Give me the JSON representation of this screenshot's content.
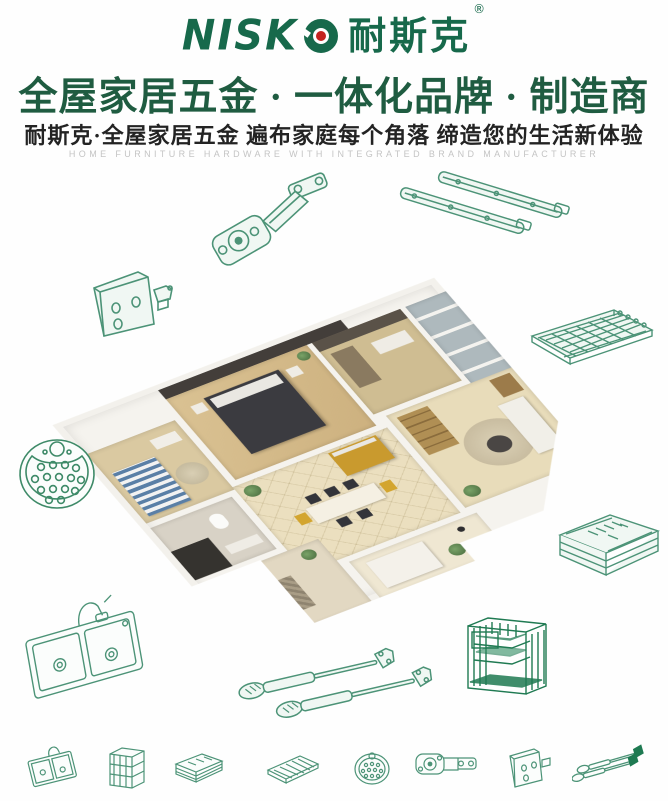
{
  "brand": {
    "latin": "NISK",
    "cjk": "耐斯克",
    "registered": "®"
  },
  "header": {
    "headline": "全屋家居五金 · 一体化品牌 · 制造商",
    "subtitle": "耐斯克·全屋家居五金  遍布家庭每个角落  缔造您的生活新体验",
    "tagline_en": "HOME FURNITURE HARDWARE WITH INTEGRATED BRAND MANUFACTURER"
  },
  "colors": {
    "brand_green": "#17694b",
    "headline_green": "#1f5c41",
    "accent_red": "#c3231f",
    "line_art_green": "#4c9377",
    "product_green": "#1f7a52",
    "subtitle_dark": "#232323",
    "tagline_gray": "#c4c4c4"
  },
  "illustrations": [
    "concealed-hinge",
    "drawer-slides",
    "wall-bracket",
    "wire-shelf",
    "perforated-plate",
    "drawer-basket",
    "kitchen-sink",
    "gas-struts",
    "wire-rack-organizer"
  ],
  "bottom_icons": [
    "sink",
    "wire-cabinet",
    "drawer-basket",
    "wire-shelf",
    "perforated-plate",
    "concealed-hinge",
    "wall-bracket",
    "gas-struts"
  ]
}
